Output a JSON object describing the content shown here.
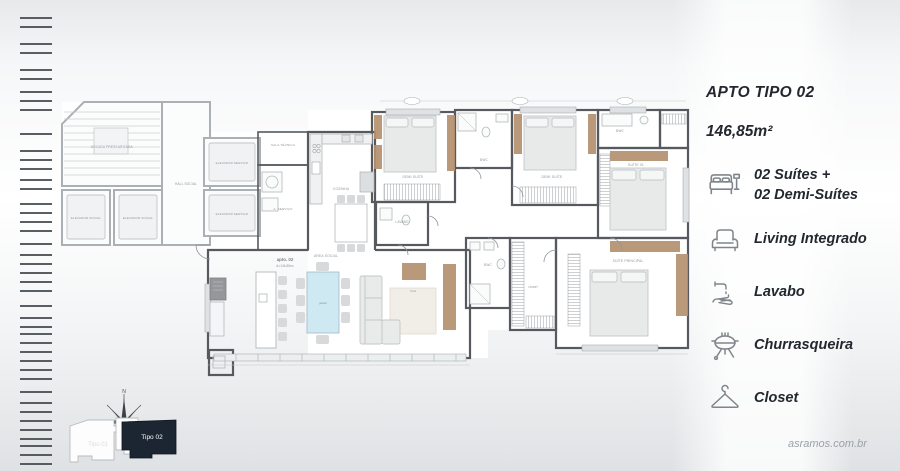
{
  "panel": {
    "title": "APTO TIPO 02",
    "area": "146,85m²",
    "features": [
      {
        "icon": "bed-icon",
        "label": "02 Suítes +\n02 Demi-Suítes"
      },
      {
        "icon": "armchair-icon",
        "label": "Living Integrado"
      },
      {
        "icon": "handwash-icon",
        "label": "Lavabo"
      },
      {
        "icon": "grill-icon",
        "label": "Churrasqueira"
      },
      {
        "icon": "hanger-icon",
        "label": "Closet"
      }
    ]
  },
  "plan": {
    "unit": {
      "name": "apto. 02",
      "area": "A=146,85m²"
    },
    "rooms": {
      "stairs": "ESCADA PRESSURIZADA",
      "elevator_social_1": "ELEVADOR SOCIAL",
      "elevator_social_2": "ELEVADOR SOCIAL",
      "hall_social": "HALL SOCIAL",
      "elevator_service_1": "ELEVADOR SERVIÇO",
      "elevator_service_2": "ELEVADOR SERVIÇO",
      "sala_tecnica": "SALA TÉCNICA",
      "area_servico": "A. SERVIÇO",
      "kitchen": "COZINHA",
      "social": "ÁREA SOCIAL",
      "demi_suite_1": "DEMI SUÍTE",
      "demi_suite_2": "DEMI SUÍTE",
      "lavabo": "LAVABO",
      "bwc_shared": "BWC",
      "bwc_top": "BWC",
      "bwc_master": "BWC",
      "suite_01": "SUÍTE 01",
      "suite_master": "SUÍTE PRINCIPAL",
      "closet": "closet",
      "dining_table": "jantar",
      "sofa": "Sofá"
    },
    "compass": {
      "north": "N"
    },
    "keyplan": {
      "active_unit": "Tipo 02",
      "adjacent_unit": "Tipo 01"
    }
  },
  "colors": {
    "wall_dark": "#56595d",
    "wall_light": "#aab0b4",
    "wood_accent": "#b4916f",
    "table_glass": "#cfe9f3",
    "keyplan_active": "#1c2632",
    "text_dark": "#23272e",
    "icon_gray": "#7f858a"
  },
  "watermark": "asramos.com.br"
}
